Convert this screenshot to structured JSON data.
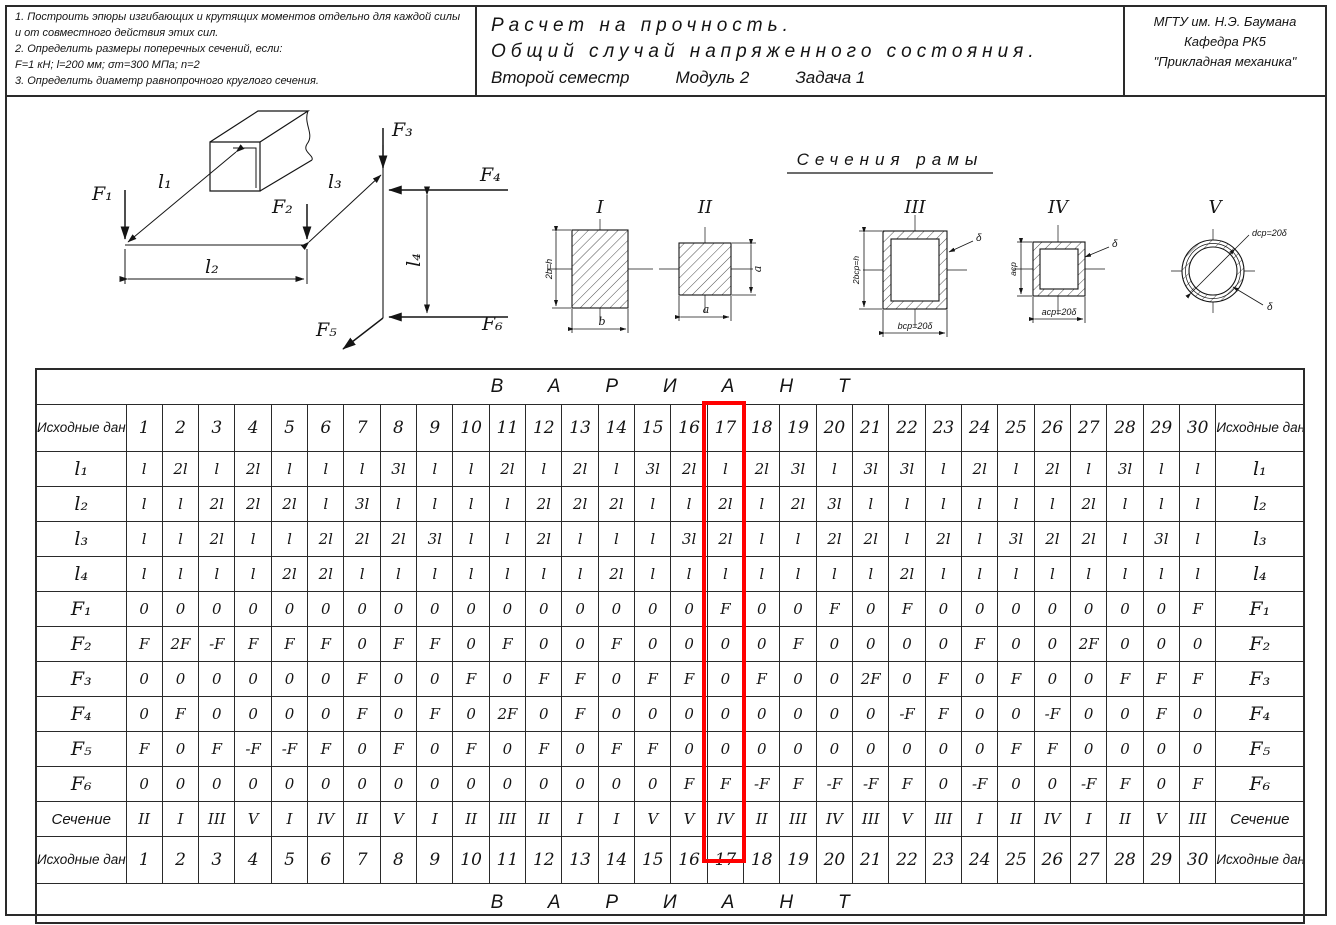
{
  "header": {
    "tasks": [
      "1.  Построить эпюры изгибающих и крутящих моментов отдельно для каждой силы и от совместного действия этих сил.",
      "2.  Определить размеры поперечных сечений, если:",
      "F=1 кН;  l=200 мм;  σт=300 МПа;  n=2",
      "3.  Определить диаметр равнопрочного круглого сечения."
    ],
    "title1": "Расчет на прочность.",
    "title2": "Общий случай напряженного состояния.",
    "title3_parts": [
      "Второй семестр",
      "Модуль 2",
      "Задача 1"
    ],
    "org": [
      "МГТУ им. Н.Э. Баумана",
      "Кафедра РК5",
      "\"Прикладная механика\""
    ]
  },
  "diagram": {
    "f1": "F₁",
    "f2": "F₂",
    "f3": "F₃",
    "f4": "F₄",
    "f5": "F₅",
    "f6": "F₆",
    "l1": "l₁",
    "l2": "l₂",
    "l3": "l₃",
    "l4": "l₄"
  },
  "sections": {
    "title": "Сечения рамы",
    "numerals": [
      "I",
      "II",
      "III",
      "IV",
      "V"
    ],
    "s1": {
      "left": "2b=h",
      "bottom": "b"
    },
    "s2": {
      "right": "a",
      "bottom": "a"
    },
    "s3": {
      "left": "2bср=h",
      "bottom": "bср=20δ",
      "delta": "δ"
    },
    "s4": {
      "left": "aср",
      "bottom": "aср=20δ",
      "delta": "δ"
    },
    "s5": {
      "diag": "dср=20δ",
      "delta": "δ"
    }
  },
  "table": {
    "variant_header": "ВАРИАНТ",
    "corner_label": "Исходные данные",
    "variants": [
      "1",
      "2",
      "3",
      "4",
      "5",
      "6",
      "7",
      "8",
      "9",
      "10",
      "11",
      "12",
      "13",
      "14",
      "15",
      "16",
      "17",
      "18",
      "19",
      "20",
      "21",
      "22",
      "23",
      "24",
      "25",
      "26",
      "27",
      "28",
      "29",
      "30"
    ],
    "highlighted_variant": "17",
    "highlight_color": "#ff0000",
    "rows": [
      {
        "label": "l₁",
        "type": "sym",
        "values": [
          "l",
          "2l",
          "l",
          "2l",
          "l",
          "l",
          "l",
          "3l",
          "l",
          "l",
          "2l",
          "l",
          "2l",
          "l",
          "3l",
          "2l",
          "l",
          "2l",
          "3l",
          "l",
          "3l",
          "3l",
          "l",
          "2l",
          "l",
          "2l",
          "l",
          "3l",
          "l",
          "l"
        ]
      },
      {
        "label": "l₂",
        "type": "sym",
        "values": [
          "l",
          "l",
          "2l",
          "2l",
          "2l",
          "l",
          "3l",
          "l",
          "l",
          "l",
          "l",
          "2l",
          "2l",
          "2l",
          "l",
          "l",
          "2l",
          "l",
          "2l",
          "3l",
          "l",
          "l",
          "l",
          "l",
          "l",
          "l",
          "2l",
          "l",
          "l",
          "l"
        ]
      },
      {
        "label": "l₃",
        "type": "sym",
        "values": [
          "l",
          "l",
          "2l",
          "l",
          "l",
          "2l",
          "2l",
          "2l",
          "3l",
          "l",
          "l",
          "2l",
          "l",
          "l",
          "l",
          "3l",
          "2l",
          "l",
          "l",
          "2l",
          "2l",
          "l",
          "2l",
          "l",
          "3l",
          "2l",
          "2l",
          "l",
          "3l",
          "l"
        ]
      },
      {
        "label": "l₄",
        "type": "sym",
        "values": [
          "l",
          "l",
          "l",
          "l",
          "2l",
          "2l",
          "l",
          "l",
          "l",
          "l",
          "l",
          "l",
          "l",
          "2l",
          "l",
          "l",
          "l",
          "l",
          "l",
          "l",
          "l",
          "2l",
          "l",
          "l",
          "l",
          "l",
          "l",
          "l",
          "l",
          "l"
        ]
      },
      {
        "label": "F₁",
        "type": "sym",
        "values": [
          "0",
          "0",
          "0",
          "0",
          "0",
          "0",
          "0",
          "0",
          "0",
          "0",
          "0",
          "0",
          "0",
          "0",
          "0",
          "0",
          "F",
          "0",
          "0",
          "F",
          "0",
          "F",
          "0",
          "0",
          "0",
          "0",
          "0",
          "0",
          "0",
          "F"
        ]
      },
      {
        "label": "F₂",
        "type": "sym",
        "values": [
          "F",
          "2F",
          "-F",
          "F",
          "F",
          "F",
          "0",
          "F",
          "F",
          "0",
          "F",
          "0",
          "0",
          "F",
          "0",
          "0",
          "0",
          "0",
          "F",
          "0",
          "0",
          "0",
          "0",
          "F",
          "0",
          "0",
          "2F",
          "0",
          "0",
          "0"
        ]
      },
      {
        "label": "F₃",
        "type": "sym",
        "values": [
          "0",
          "0",
          "0",
          "0",
          "0",
          "0",
          "F",
          "0",
          "0",
          "F",
          "0",
          "F",
          "F",
          "0",
          "F",
          "F",
          "0",
          "F",
          "0",
          "0",
          "2F",
          "0",
          "F",
          "0",
          "F",
          "0",
          "0",
          "F",
          "F",
          "F"
        ]
      },
      {
        "label": "F₄",
        "type": "sym",
        "values": [
          "0",
          "F",
          "0",
          "0",
          "0",
          "0",
          "F",
          "0",
          "F",
          "0",
          "2F",
          "0",
          "F",
          "0",
          "0",
          "0",
          "0",
          "0",
          "0",
          "0",
          "0",
          "-F",
          "F",
          "0",
          "0",
          "-F",
          "0",
          "0",
          "F",
          "0"
        ]
      },
      {
        "label": "F₅",
        "type": "sym",
        "values": [
          "F",
          "0",
          "F",
          "-F",
          "-F",
          "F",
          "0",
          "F",
          "0",
          "F",
          "0",
          "F",
          "0",
          "F",
          "F",
          "0",
          "0",
          "0",
          "0",
          "0",
          "0",
          "0",
          "0",
          "0",
          "F",
          "F",
          "0",
          "0",
          "0",
          "0"
        ]
      },
      {
        "label": "F₆",
        "type": "sym",
        "values": [
          "0",
          "0",
          "0",
          "0",
          "0",
          "0",
          "0",
          "0",
          "0",
          "0",
          "0",
          "0",
          "0",
          "0",
          "0",
          "F",
          "F",
          "-F",
          "F",
          "-F",
          "-F",
          "F",
          "0",
          "-F",
          "0",
          "0",
          "-F",
          "F",
          "0",
          "F"
        ]
      },
      {
        "label": "Сечение",
        "type": "section",
        "values": [
          "II",
          "I",
          "III",
          "V",
          "I",
          "IV",
          "II",
          "V",
          "I",
          "II",
          "III",
          "II",
          "I",
          "I",
          "V",
          "V",
          "IV",
          "II",
          "III",
          "IV",
          "III",
          "V",
          "III",
          "I",
          "II",
          "IV",
          "I",
          "II",
          "V",
          "III"
        ]
      }
    ]
  }
}
